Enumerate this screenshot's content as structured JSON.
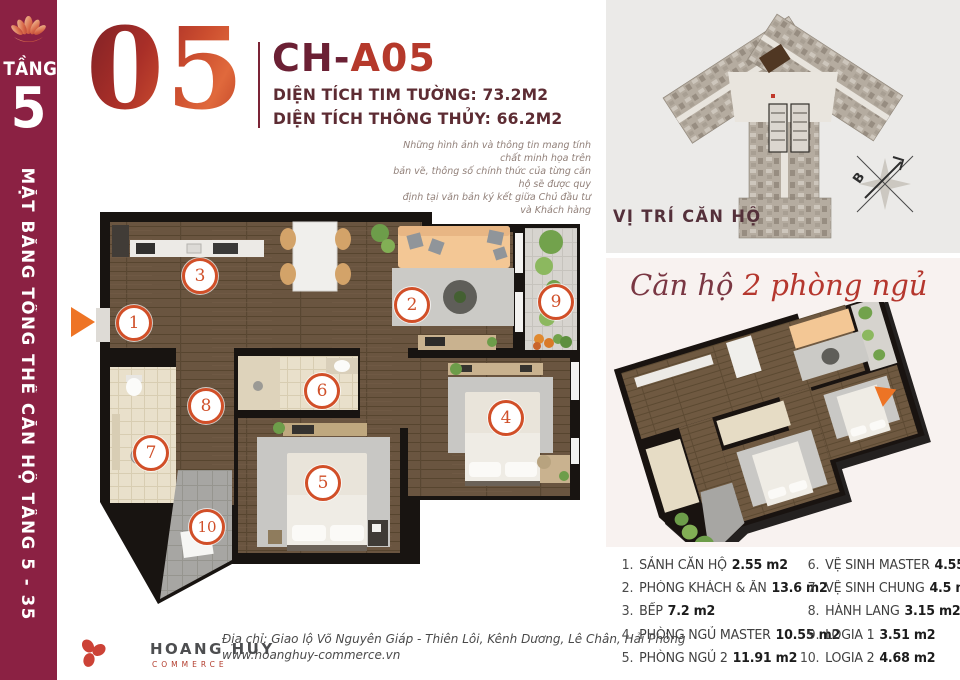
{
  "colors": {
    "sidebar_bg": "#8b2143",
    "accent_orange": "#ed7425",
    "marker_orange": "#d14f28",
    "heading_maroon": "#6b2034",
    "heading_red": "#b5392b",
    "text_maroon": "#5d2c33"
  },
  "sidebar": {
    "floor_label": "TẦNG",
    "floor_number": "5",
    "vertical_title": "MẶT BẰNG TỔNG THỂ CĂN HỘ TẦNG 5 - 35"
  },
  "header": {
    "unit_big": "05",
    "unit_code_prefix": "CH-",
    "unit_code_suffix": "A05",
    "area_line_1": "DIỆN TÍCH TIM TƯỜNG: 73.2M2",
    "area_line_2": "DIỆN TÍCH THÔNG THỦY: 66.2M2",
    "disclaimer_line_1": "Những hình ảnh và thông tin mang tính chất minh họa trên",
    "disclaimer_line_2": "bản vẽ, thông số chính thức của từng căn hộ sẽ được quy",
    "disclaimer_line_3": "định tại văn bản ký kết giữa Chủ đầu tư và Khách hàng"
  },
  "site_plan": {
    "caption": "VỊ TRÍ CĂN HỘ",
    "compass_label": "B"
  },
  "unit_overview": {
    "title_prefix": "Căn hộ",
    "title_suffix": " 2 phòng ngủ"
  },
  "floor_plan": {
    "marker_labels": [
      "1",
      "2",
      "3",
      "4",
      "5",
      "6",
      "7",
      "8",
      "9",
      "10"
    ]
  },
  "legend": {
    "left": [
      {
        "num": "1.",
        "name": "SẢNH CĂN HỘ",
        "area": "2.55 m2"
      },
      {
        "num": "2.",
        "name": "PHÒNG KHÁCH & ĂN",
        "area": "13.6 m2"
      },
      {
        "num": "3.",
        "name": "BẾP",
        "area": "7.2 m2"
      },
      {
        "num": "4.",
        "name": "PHÒNG NGỦ MASTER",
        "area": "10.55 m2"
      },
      {
        "num": "5.",
        "name": "PHÒNG NGỦ 2",
        "area": "11.91 m2"
      }
    ],
    "right": [
      {
        "num": "6.",
        "name": "VỆ SINH MASTER",
        "area": "4.55 m2"
      },
      {
        "num": "7.",
        "name": "VỆ SINH CHUNG",
        "area": "4.5 m2"
      },
      {
        "num": "8.",
        "name": "HÀNH LANG",
        "area": "3.15 m2"
      },
      {
        "num": "9.",
        "name": "LOGIA 1",
        "area": "3.51 m2"
      },
      {
        "num": "10.",
        "name": "LOGIA 2",
        "area": "4.68 m2"
      }
    ]
  },
  "footer": {
    "brand": "HOANG HUY",
    "brand_sub": "COMMERCE",
    "address": "Địa chỉ: Giao lộ Võ Nguyên Giáp - Thiên Lôi, Kênh Dương, Lê Chân, Hải Phòng",
    "website": "www.hoanghuy-commerce.vn"
  }
}
